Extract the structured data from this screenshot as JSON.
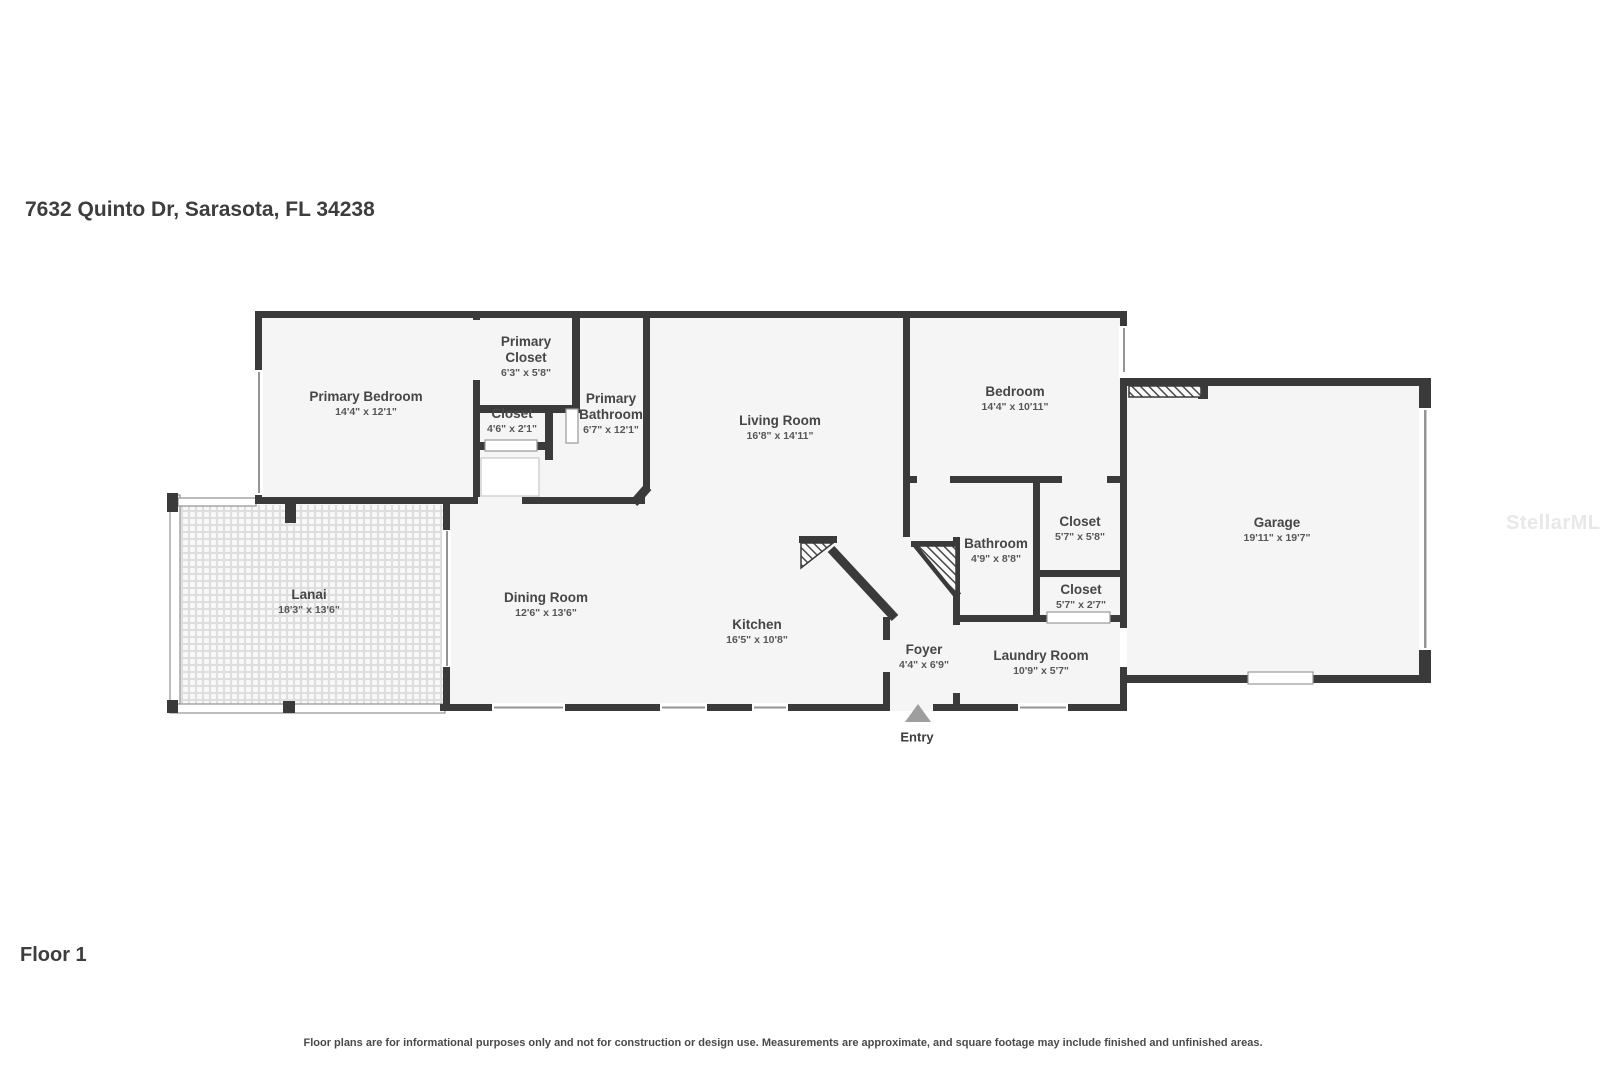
{
  "title": "7632 Quinto Dr, Sarasota, FL 34238",
  "floor_label": "Floor 1",
  "entry_label": "Entry",
  "watermark": "StellarMLS",
  "disclaimer": "Floor plans are for informational purposes only and not for construction or design use. Measurements are approximate, and square footage may include finished and unfinished areas.",
  "colors": {
    "wall": "#3a3a3a",
    "room_fill": "#f5f5f5",
    "label_text": "#464646",
    "watermark": "#e8e8e8",
    "entry_arrow": "#9e9e9e"
  },
  "rooms": [
    {
      "name": "Primary Bedroom",
      "dims": "14'4\" x 12'1\""
    },
    {
      "name": "Primary Closet",
      "dims": "6'3\" x 5'8\""
    },
    {
      "name": "Closet",
      "dims": "4'6\" x 2'1\""
    },
    {
      "name": "Primary Bathroom",
      "dims": "6'7\" x 12'1\""
    },
    {
      "name": "Living Room",
      "dims": "16'8\" x 14'11\""
    },
    {
      "name": "Bedroom",
      "dims": "14'4\" x 10'11\""
    },
    {
      "name": "Garage",
      "dims": "19'11\" x 19'7\""
    },
    {
      "name": "Lanai",
      "dims": "18'3\" x 13'6\""
    },
    {
      "name": "Dining Room",
      "dims": "12'6\" x 13'6\""
    },
    {
      "name": "Kitchen",
      "dims": "16'5\" x 10'8\""
    },
    {
      "name": "Bathroom",
      "dims": "4'9\" x 8'8\""
    },
    {
      "name": "Closet",
      "dims": "5'7\" x 5'8\""
    },
    {
      "name": "Closet",
      "dims": "5'7\" x 2'7\""
    },
    {
      "name": "Foyer",
      "dims": "4'4\" x 6'9\""
    },
    {
      "name": "Laundry Room",
      "dims": "10'9\" x 5'7\""
    }
  ]
}
